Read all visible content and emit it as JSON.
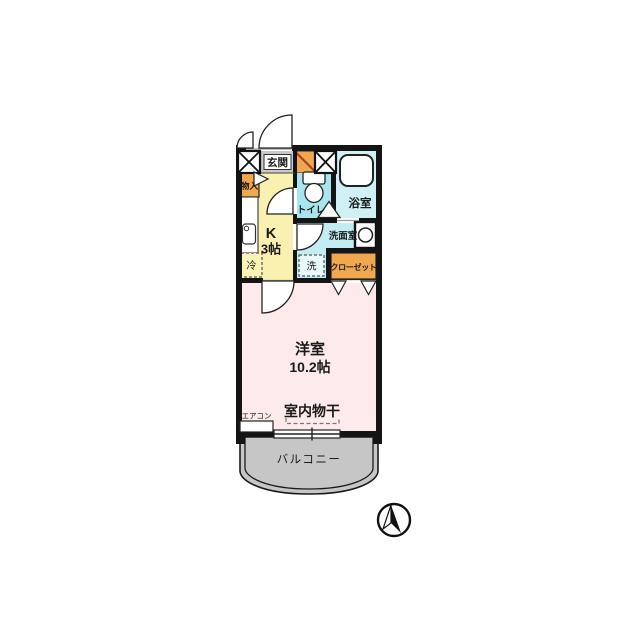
{
  "floor_plan": {
    "entrance": {
      "label": "玄関"
    },
    "storage": {
      "label": "物入"
    },
    "kitchen": {
      "label": "K",
      "size": "3帖"
    },
    "refrigerator": {
      "label": "冷"
    },
    "toilet": {
      "label": "トイレ"
    },
    "bathroom": {
      "label": "浴室"
    },
    "washroom": {
      "label": "洗面室"
    },
    "washer": {
      "label": "洗"
    },
    "closet": {
      "label": "クローゼット"
    },
    "main_room": {
      "label": "洋室",
      "size": "10.2帖"
    },
    "indoor_drying": {
      "label": "室内物干"
    },
    "air_conditioner": {
      "label": "エアコン"
    },
    "balcony": {
      "label": "バルコニー"
    },
    "compass_icon": "north-arrow"
  },
  "colors": {
    "wall": "#141414",
    "entrance_floor": "#c9c9c9",
    "storage_orange": "#f0a84e",
    "kitchen_yellow": "#faf0b0",
    "toilet_cyan": "#a9e5ef",
    "bath_cyan": "#cff0f5",
    "washroom_cyan": "#c2edf3",
    "room_pink": "#fdeaea",
    "balcony_gray": "#c6c6c6"
  }
}
